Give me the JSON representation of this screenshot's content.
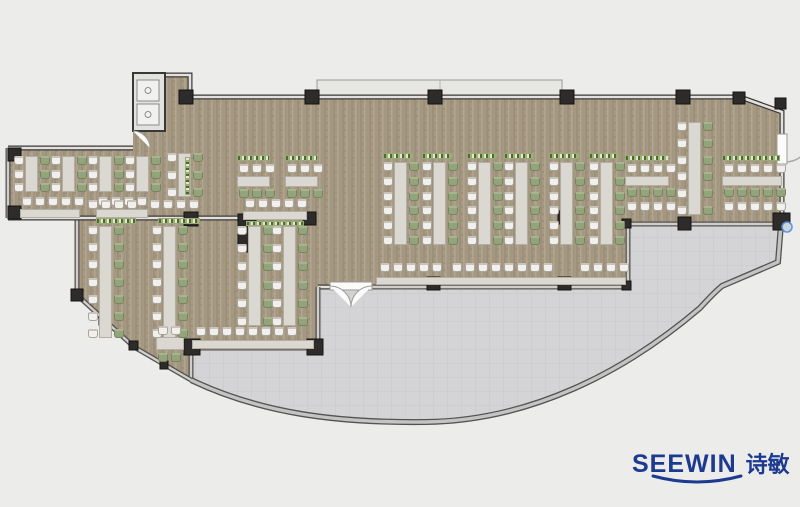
{
  "canvas": {
    "w": 800,
    "h": 507
  },
  "logo": {
    "brand": "SEEWIN",
    "brand_cn": "诗敏",
    "color": "#1d3a91",
    "brand_size": 25,
    "cn_size": 22,
    "x": 632,
    "y": 452
  },
  "palette": {
    "page_bg": "#ececeb",
    "carpet_base": "#a79a85",
    "carpet_streak_dark": "#9d9079",
    "carpet_streak_light": "#b2a58f",
    "terrace": "#d4d4d6",
    "terrace_grid": "#c6c6c9",
    "wall_dark": "#3a3836",
    "wall_fill": "#e2e1de",
    "glass_dark": "#55534f",
    "glass_fill": "#cfcecb",
    "arc_fill": "#c4c4c6",
    "column": "#2e2c2a",
    "canopy": "#e6e6e3",
    "door_white": "#fbfbfa",
    "marker_blue": "#5b8fd4"
  },
  "plan": {
    "dining_path": "M8,148 L133,148 L133,131 L163,131 L163,75 L190,75 L190,97 L740,97 L782,112 L782,224 L628,224 L628,287 L318,287 L318,348 L192,348 L191,380 L134,347 L77,295 L77,218 L8,218 Z",
    "terrace_path": "M192,348 L318,348 L318,287 L628,287 L628,224 L781,224 L778,262 L722,286 C716,291 710,297 700,308 C625,372 530,421 425,422 C335,423 260,413 191,380 Z",
    "canopy": {
      "x": 317,
      "y": 80,
      "w": 245,
      "h": 18,
      "seam_x": 440
    },
    "vestibule": {
      "x": 133,
      "y": 73,
      "w": 32,
      "h": 58,
      "fixtures": [
        {
          "x": 137,
          "y": 80,
          "w": 22,
          "h": 21
        },
        {
          "x": 137,
          "y": 104,
          "w": 22,
          "h": 21
        }
      ]
    },
    "walls": [
      {
        "d": "M185,97 L740,97",
        "kind": "wall"
      },
      {
        "d": "M163,131 L163,75 L190,75 L190,97",
        "kind": "wall"
      },
      {
        "d": "M740,97 L782,112 L782,135",
        "kind": "wall"
      },
      {
        "d": "M782,163 L782,224",
        "kind": "wall"
      },
      {
        "d": "M628,224 L781,224",
        "kind": "glass"
      },
      {
        "d": "M628,224 L628,287",
        "kind": "glass"
      },
      {
        "d": "M318,287 L330,287",
        "kind": "wall"
      },
      {
        "d": "M372,287 L628,287",
        "kind": "glass"
      },
      {
        "d": "M318,287 L318,348",
        "kind": "glass"
      },
      {
        "d": "M192,348 L318,348",
        "kind": "glass"
      },
      {
        "d": "M191,348 L191,380",
        "kind": "glass"
      },
      {
        "d": "M77,295 L134,347 L191,380",
        "kind": "glass"
      },
      {
        "d": "M77,218 L77,295",
        "kind": "glass"
      },
      {
        "d": "M8,218 L240,218",
        "kind": "wall"
      },
      {
        "d": "M8,148 L8,218",
        "kind": "glass"
      },
      {
        "d": "M8,148 L133,148",
        "kind": "wall"
      },
      {
        "d": "M191,380 C260,413 335,423 425,422 C530,421 625,372 700,308 C710,297 716,291 722,286 L778,262 L781,224",
        "kind": "arc"
      }
    ],
    "columns": [
      {
        "x": 179,
        "y": 90,
        "w": 14,
        "h": 14
      },
      {
        "x": 305,
        "y": 90,
        "w": 14,
        "h": 14
      },
      {
        "x": 428,
        "y": 90,
        "w": 14,
        "h": 14
      },
      {
        "x": 560,
        "y": 90,
        "w": 14,
        "h": 14
      },
      {
        "x": 676,
        "y": 90,
        "w": 14,
        "h": 14
      },
      {
        "x": 733,
        "y": 92,
        "w": 12,
        "h": 12
      },
      {
        "x": 775,
        "y": 98,
        "w": 11,
        "h": 11
      },
      {
        "x": 773,
        "y": 213,
        "w": 17,
        "h": 17
      },
      {
        "x": 678,
        "y": 217,
        "w": 13,
        "h": 13
      },
      {
        "x": 622,
        "y": 219,
        "w": 9,
        "h": 9
      },
      {
        "x": 427,
        "y": 277,
        "w": 13,
        "h": 13
      },
      {
        "x": 558,
        "y": 277,
        "w": 13,
        "h": 13
      },
      {
        "x": 622,
        "y": 281,
        "w": 9,
        "h": 9
      },
      {
        "x": 184,
        "y": 339,
        "w": 16,
        "h": 16
      },
      {
        "x": 307,
        "y": 339,
        "w": 16,
        "h": 16
      },
      {
        "x": 184,
        "y": 212,
        "w": 14,
        "h": 14
      },
      {
        "x": 303,
        "y": 212,
        "w": 13,
        "h": 13
      },
      {
        "x": 558,
        "y": 211,
        "w": 13,
        "h": 13
      },
      {
        "x": 238,
        "y": 214,
        "w": 18,
        "h": 38
      },
      {
        "x": 8,
        "y": 148,
        "w": 13,
        "h": 13
      },
      {
        "x": 8,
        "y": 206,
        "w": 13,
        "h": 13
      },
      {
        "x": 71,
        "y": 289,
        "w": 12,
        "h": 12
      },
      {
        "x": 99,
        "y": 317,
        "w": 8,
        "h": 8
      },
      {
        "x": 129,
        "y": 341,
        "w": 9,
        "h": 9
      },
      {
        "x": 160,
        "y": 361,
        "w": 8,
        "h": 8
      }
    ],
    "doors": {
      "main": {
        "x": 330,
        "y": 282,
        "w": 42,
        "h": 8
      },
      "right": {
        "x": 777,
        "y": 134,
        "w": 10,
        "h": 30
      },
      "vestibule": {
        "cx": 133,
        "cy": 131,
        "r": 17
      }
    },
    "marker": {
      "cx": 787,
      "cy": 227,
      "r": 5
    },
    "furniture": {
      "vclusters": [
        {
          "x": 14,
          "y": 156,
          "len": 36,
          "n": 3
        },
        {
          "x": 51,
          "y": 156,
          "len": 36,
          "n": 3
        },
        {
          "x": 88,
          "y": 156,
          "len": 36,
          "n": 3
        },
        {
          "x": 125,
          "y": 156,
          "len": 36,
          "n": 3
        },
        {
          "x": 167,
          "y": 153,
          "len": 44,
          "n": 3
        },
        {
          "x": 88,
          "y": 226,
          "len": 112,
          "n": 7
        },
        {
          "x": 152,
          "y": 226,
          "len": 112,
          "n": 7
        },
        {
          "x": 237,
          "y": 226,
          "len": 100,
          "n": 6
        },
        {
          "x": 272,
          "y": 226,
          "len": 100,
          "n": 6
        },
        {
          "x": 383,
          "y": 162,
          "len": 83,
          "n": 6
        },
        {
          "x": 422,
          "y": 162,
          "len": 83,
          "n": 6
        },
        {
          "x": 467,
          "y": 162,
          "len": 83,
          "n": 6
        },
        {
          "x": 504,
          "y": 162,
          "len": 83,
          "n": 6
        },
        {
          "x": 549,
          "y": 162,
          "len": 83,
          "n": 6
        },
        {
          "x": 589,
          "y": 162,
          "len": 83,
          "n": 6
        },
        {
          "x": 677,
          "y": 122,
          "len": 93,
          "n": 6
        }
      ],
      "htables": [
        {
          "x": 237,
          "y": 176,
          "w": 33,
          "h": 11
        },
        {
          "x": 285,
          "y": 176,
          "w": 33,
          "h": 11
        },
        {
          "x": 625,
          "y": 176,
          "w": 44,
          "h": 10
        },
        {
          "x": 722,
          "y": 176,
          "w": 60,
          "h": 10
        },
        {
          "x": 156,
          "y": 337,
          "w": 28,
          "h": 13
        }
      ],
      "rows": [
        {
          "x": 22,
          "y": 197,
          "n": 5,
          "c": "white"
        },
        {
          "x": 98,
          "y": 197,
          "n": 4,
          "c": "white"
        },
        {
          "x": 88,
          "y": 200,
          "n": 4,
          "c": "white"
        },
        {
          "x": 150,
          "y": 200,
          "n": 4,
          "c": "white"
        },
        {
          "x": 245,
          "y": 199,
          "n": 5,
          "c": "white"
        },
        {
          "x": 239,
          "y": 164,
          "n": 3,
          "c": "white"
        },
        {
          "x": 239,
          "y": 189,
          "n": 3,
          "c": "green"
        },
        {
          "x": 287,
          "y": 164,
          "n": 3,
          "c": "white"
        },
        {
          "x": 287,
          "y": 189,
          "n": 3,
          "c": "green"
        },
        {
          "x": 196,
          "y": 327,
          "n": 8,
          "c": "white"
        },
        {
          "x": 158,
          "y": 326,
          "n": 2,
          "c": "white"
        },
        {
          "x": 158,
          "y": 353,
          "n": 2,
          "c": "green"
        },
        {
          "x": 380,
          "y": 263,
          "n": 5,
          "c": "white"
        },
        {
          "x": 452,
          "y": 263,
          "n": 8,
          "c": "white"
        },
        {
          "x": 580,
          "y": 263,
          "n": 4,
          "c": "white"
        },
        {
          "x": 627,
          "y": 164,
          "n": 4,
          "c": "white"
        },
        {
          "x": 627,
          "y": 188,
          "n": 4,
          "c": "green"
        },
        {
          "x": 627,
          "y": 202,
          "n": 4,
          "c": "white"
        },
        {
          "x": 724,
          "y": 164,
          "n": 5,
          "c": "white"
        },
        {
          "x": 724,
          "y": 188,
          "n": 5,
          "c": "green"
        },
        {
          "x": 724,
          "y": 202,
          "n": 5,
          "c": "white"
        }
      ],
      "strips": [
        {
          "x": 20,
          "y": 209,
          "w": 60,
          "h": 9
        },
        {
          "x": 96,
          "y": 209,
          "w": 52,
          "h": 9
        },
        {
          "x": 243,
          "y": 211,
          "w": 64,
          "h": 9
        },
        {
          "x": 192,
          "y": 340,
          "w": 122,
          "h": 9
        },
        {
          "x": 376,
          "y": 277,
          "w": 250,
          "h": 8
        }
      ],
      "plants": [
        {
          "x": 96,
          "y": 218,
          "w": 40,
          "h": 6
        },
        {
          "x": 158,
          "y": 218,
          "w": 42,
          "h": 6
        },
        {
          "x": 246,
          "y": 221,
          "w": 58,
          "h": 5
        },
        {
          "x": 237,
          "y": 155,
          "w": 33,
          "h": 6
        },
        {
          "x": 285,
          "y": 155,
          "w": 33,
          "h": 6
        },
        {
          "x": 383,
          "y": 153,
          "w": 30,
          "h": 6
        },
        {
          "x": 422,
          "y": 153,
          "w": 30,
          "h": 6
        },
        {
          "x": 467,
          "y": 153,
          "w": 30,
          "h": 6
        },
        {
          "x": 504,
          "y": 153,
          "w": 30,
          "h": 6
        },
        {
          "x": 549,
          "y": 153,
          "w": 30,
          "h": 6
        },
        {
          "x": 589,
          "y": 153,
          "w": 30,
          "h": 6
        },
        {
          "x": 625,
          "y": 155,
          "w": 44,
          "h": 6
        },
        {
          "x": 722,
          "y": 155,
          "w": 58,
          "h": 6
        },
        {
          "x": 185,
          "y": 157,
          "w": 5,
          "h": 38,
          "v": true
        }
      ]
    }
  }
}
